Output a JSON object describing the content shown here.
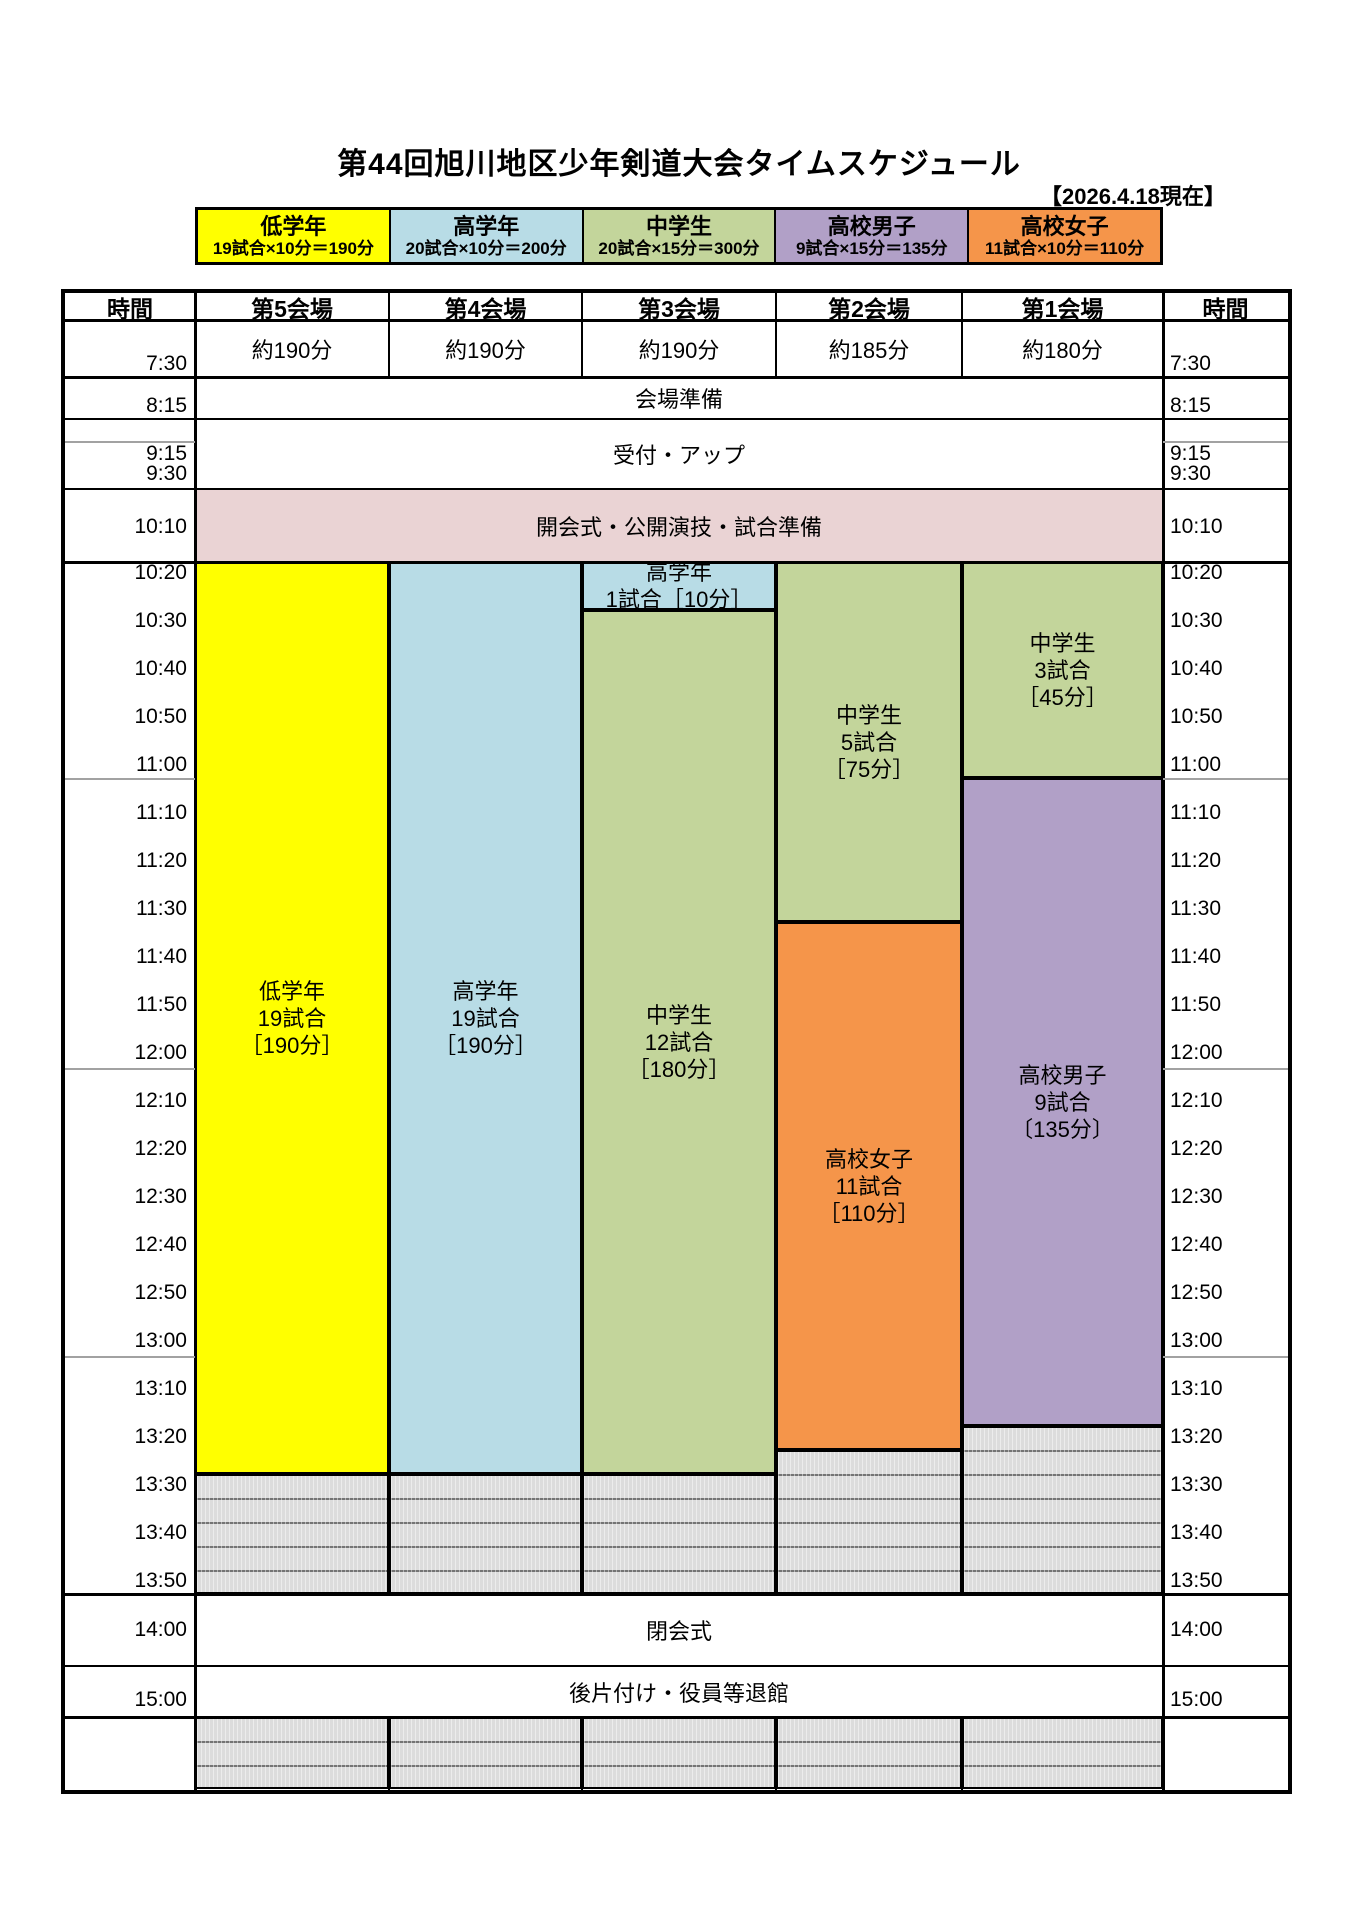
{
  "page": {
    "title": "第44回旭川地区少年剣道大会タイムスケジュール",
    "date_note": "【2026.4.18現在】"
  },
  "legend": [
    {
      "name": "低学年",
      "formula": "19試合×10分＝190分",
      "color": "#ffff00"
    },
    {
      "name": "高学年",
      "formula": "20試合×10分＝200分",
      "color": "#b8dce6"
    },
    {
      "name": "中学生",
      "formula": "20試合×15分＝300分",
      "color": "#c3d59b"
    },
    {
      "name": "高校男子",
      "formula": "9試合×15分＝135分",
      "color": "#b1a0c7"
    },
    {
      "name": "高校女子",
      "formula": "11試合×10分＝110分",
      "color": "#f5954a"
    }
  ],
  "table": {
    "headers": [
      "時間",
      "第5会場",
      "第4会場",
      "第3会場",
      "第2会場",
      "第1会場",
      "時間"
    ],
    "durations": [
      "約190分",
      "約190分",
      "約190分",
      "約185分",
      "約180分"
    ],
    "full_rows": [
      {
        "label": "会場準備",
        "y0": 377,
        "y1": 419,
        "bg": "#ffffff"
      },
      {
        "label": "受付・アップ",
        "y0": 419,
        "y1": 489,
        "bg": "#ffffff"
      },
      {
        "label": "開会式・公開演技・試合準備",
        "y0": 489,
        "y1": 562,
        "bg": "#ead3d4"
      },
      {
        "label": "閉会式",
        "y0": 1594,
        "y1": 1666,
        "bg": "#ffffff"
      },
      {
        "label": "後片付け・役員等退館",
        "y0": 1666,
        "y1": 1717,
        "bg": "#ffffff"
      }
    ],
    "time_labels": [
      {
        "t": "7:30",
        "y": 364
      },
      {
        "t": "8:15",
        "y": 406
      },
      {
        "t": "9:15",
        "y": 454
      },
      {
        "t": "9:30",
        "y": 474
      },
      {
        "t": "10:10",
        "y": 527
      },
      {
        "t": "10:20",
        "y": 573
      },
      {
        "t": "10:30",
        "y": 621
      },
      {
        "t": "10:40",
        "y": 669
      },
      {
        "t": "10:50",
        "y": 717
      },
      {
        "t": "11:00",
        "y": 765
      },
      {
        "t": "11:10",
        "y": 813
      },
      {
        "t": "11:20",
        "y": 861
      },
      {
        "t": "11:30",
        "y": 909
      },
      {
        "t": "11:40",
        "y": 957
      },
      {
        "t": "11:50",
        "y": 1005
      },
      {
        "t": "12:00",
        "y": 1053
      },
      {
        "t": "12:10",
        "y": 1101
      },
      {
        "t": "12:20",
        "y": 1149
      },
      {
        "t": "12:30",
        "y": 1197
      },
      {
        "t": "12:40",
        "y": 1245
      },
      {
        "t": "12:50",
        "y": 1293
      },
      {
        "t": "13:00",
        "y": 1341
      },
      {
        "t": "13:10",
        "y": 1389
      },
      {
        "t": "13:20",
        "y": 1437
      },
      {
        "t": "13:30",
        "y": 1485
      },
      {
        "t": "13:40",
        "y": 1533
      },
      {
        "t": "13:50",
        "y": 1581
      },
      {
        "t": "14:00",
        "y": 1630
      },
      {
        "t": "15:00",
        "y": 1700
      }
    ],
    "blocks": [
      {
        "venue": "v5",
        "label": "低学年\n19試合\n［190分］",
        "start": "10:20",
        "end": "13:30",
        "color": "#ffff00",
        "y0": 562,
        "y1": 1474
      },
      {
        "venue": "v4",
        "label": "高学年\n19試合\n［190分］",
        "start": "10:20",
        "end": "13:30",
        "color": "#b8dce6",
        "y0": 562,
        "y1": 1474
      },
      {
        "venue": "v3",
        "label": "高学年\n1試合［10分］",
        "start": "10:20",
        "end": "10:30",
        "color": "#b8dce6",
        "y0": 562,
        "y1": 610
      },
      {
        "venue": "v3",
        "label": "中学生\n12試合\n［180分］",
        "start": "10:30",
        "end": "13:30",
        "color": "#c3d59b",
        "y0": 610,
        "y1": 1474
      },
      {
        "venue": "v2",
        "label": "中学生\n5試合\n［75分］",
        "start": "10:20",
        "end": "11:35",
        "color": "#c3d59b",
        "y0": 562,
        "y1": 922
      },
      {
        "venue": "v2",
        "label": "高校女子\n11試合\n［110分］",
        "start": "11:35",
        "end": "13:25",
        "color": "#f5954a",
        "y0": 922,
        "y1": 1450
      },
      {
        "venue": "v1",
        "label": "中学生\n3試合\n［45分］",
        "start": "10:20",
        "end": "11:05",
        "color": "#c3d59b",
        "y0": 562,
        "y1": 778
      },
      {
        "venue": "v1",
        "label": "高校男子\n9試合\n〔135分〕",
        "start": "11:05",
        "end": "13:20",
        "color": "#b1a0c7",
        "y0": 778,
        "y1": 1426
      }
    ],
    "gray_cells": [
      {
        "venue": "v5",
        "y0": 1474,
        "y1": 1594
      },
      {
        "venue": "v4",
        "y0": 1474,
        "y1": 1594
      },
      {
        "venue": "v3",
        "y0": 1474,
        "y1": 1594
      },
      {
        "venue": "v2",
        "y0": 1450,
        "y1": 1594
      },
      {
        "venue": "v1",
        "y0": 1426,
        "y1": 1594
      },
      {
        "venue": "v5",
        "y0": 1717,
        "y1": 1789
      },
      {
        "venue": "v4",
        "y0": 1717,
        "y1": 1789
      },
      {
        "venue": "v3",
        "y0": 1717,
        "y1": 1789
      },
      {
        "venue": "v2",
        "y0": 1717,
        "y1": 1789
      },
      {
        "venue": "v1",
        "y0": 1717,
        "y1": 1789
      }
    ]
  }
}
